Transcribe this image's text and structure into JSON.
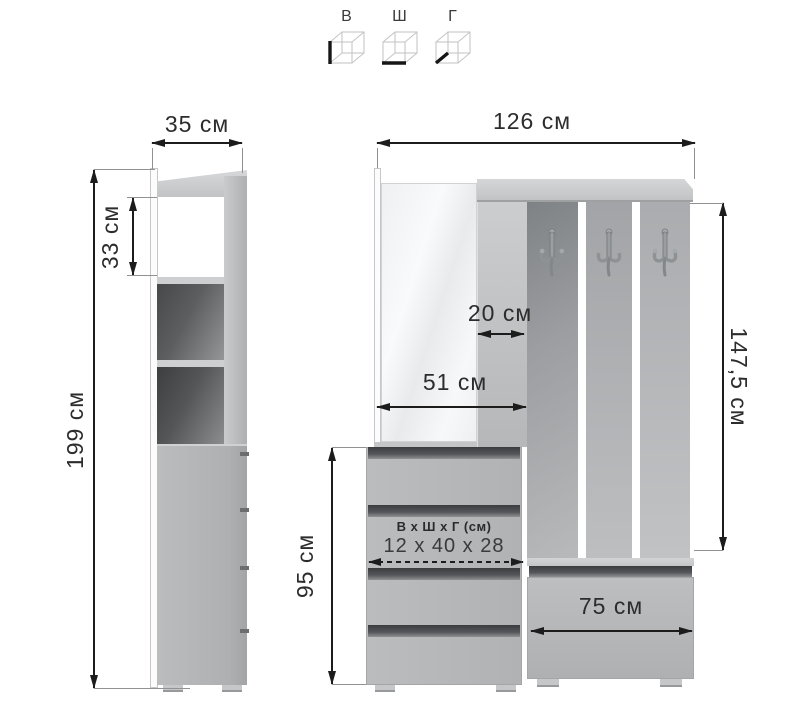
{
  "legend": {
    "items": [
      {
        "label": "В",
        "icon": "cube-height-icon"
      },
      {
        "label": "Ш",
        "icon": "cube-width-icon"
      },
      {
        "label": "Г",
        "icon": "cube-depth-icon"
      }
    ]
  },
  "left_cabinet": {
    "width_label": "35 см",
    "shelf_height_label": "33 см",
    "height_label": "199 см"
  },
  "main_unit": {
    "width_label": "126 см",
    "panel_width_label": "20 см",
    "mirror_section_width_label": "51 см",
    "hanging_height_label": "147,5 см",
    "drawer_section_height_label": "95 см",
    "bench_width_label": "75 см",
    "drawer_badge": {
      "title": "В х Ш х Г (см)",
      "value": "12 х 40 х 28"
    }
  },
  "colors": {
    "furniture_gray": "#b4b6b8",
    "dimension_line": "#1c1c1c",
    "background": "#ffffff"
  }
}
